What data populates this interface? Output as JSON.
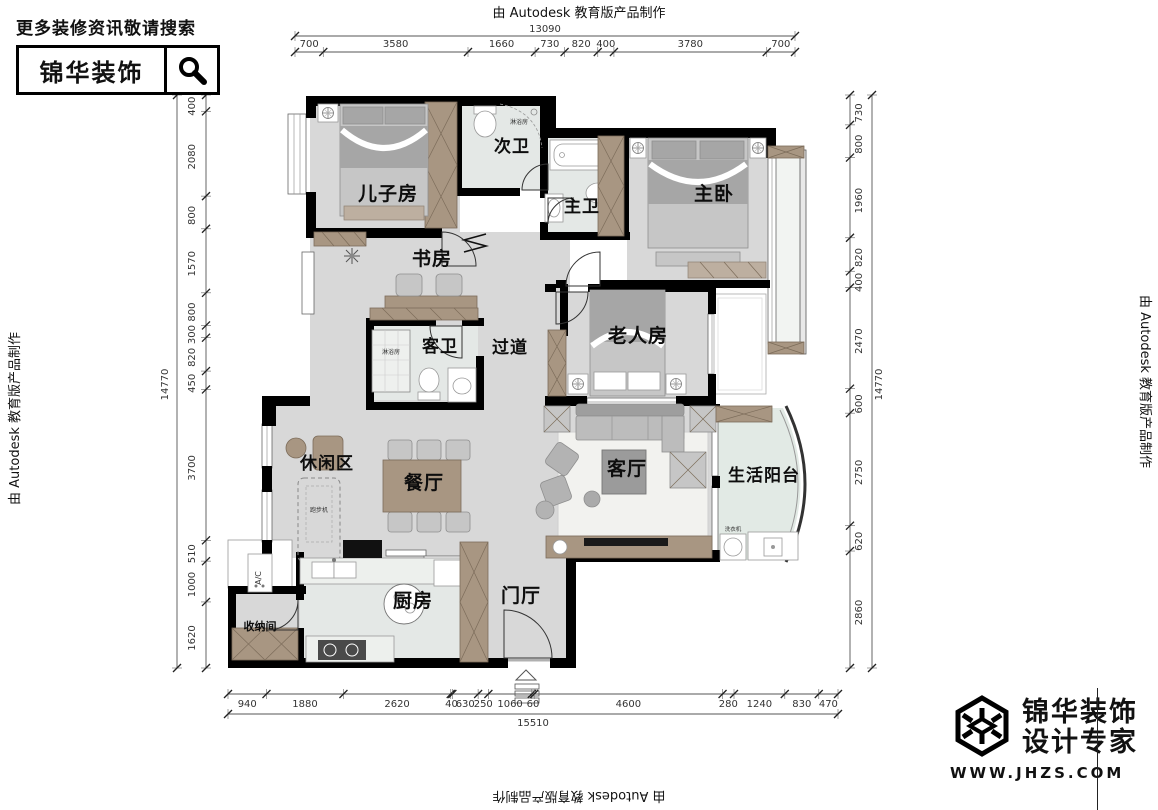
{
  "type": "floorplan",
  "watermarks": {
    "top": "由 Autodesk 教育版产品制作",
    "left": "由 Autodesk 教育版产品制作",
    "right": "由 Autodesk 教育版产品制作",
    "bottom": "由 Autodesk 教育版产品制作"
  },
  "header": {
    "tagline": "更多装修资讯敬请搜索",
    "brand": "锦华装饰"
  },
  "footer_logo": {
    "brand": "锦华装饰",
    "subtitle": "设计专家",
    "website": "WWW.JHZS.COM"
  },
  "rooms": {
    "son": "儿子房",
    "bath2": "次卫",
    "mbath": "主卫",
    "mbed": "主卧",
    "study": "书房",
    "gbath": "客卫",
    "hall": "过道",
    "elder": "老人房",
    "leisure": "休闲区",
    "dining": "餐厅",
    "living": "客厅",
    "balcony": "生活阳台",
    "kitchen": "厨房",
    "foyer": "门厅",
    "storage": "收纳间"
  },
  "labels": {
    "ac": "A/C",
    "treadmill": "跑步机",
    "shower": "淋浴房",
    "washer": "洗衣机"
  },
  "dimensions": {
    "top": {
      "total": "13090",
      "segments": [
        700,
        3580,
        1660,
        730,
        820,
        400,
        3780,
        700
      ]
    },
    "bottom": {
      "total": "15510",
      "segments": [
        940,
        1880,
        2620,
        40,
        630,
        250,
        1060,
        60,
        4600,
        280,
        1240,
        830,
        470
      ]
    },
    "left": {
      "total": "14770",
      "segments": [
        400,
        2080,
        800,
        1570,
        800,
        300,
        820,
        450,
        3700,
        510,
        1000,
        1620
      ]
    },
    "right": {
      "total": "14770",
      "segments": [
        730,
        800,
        1960,
        820,
        400,
        2470,
        600,
        2750,
        620,
        2860
      ]
    }
  },
  "colors": {
    "wall": "#000000",
    "floor": "#d8d8d8",
    "tile": "#e4e8e6",
    "wood": "#a89682"
  }
}
